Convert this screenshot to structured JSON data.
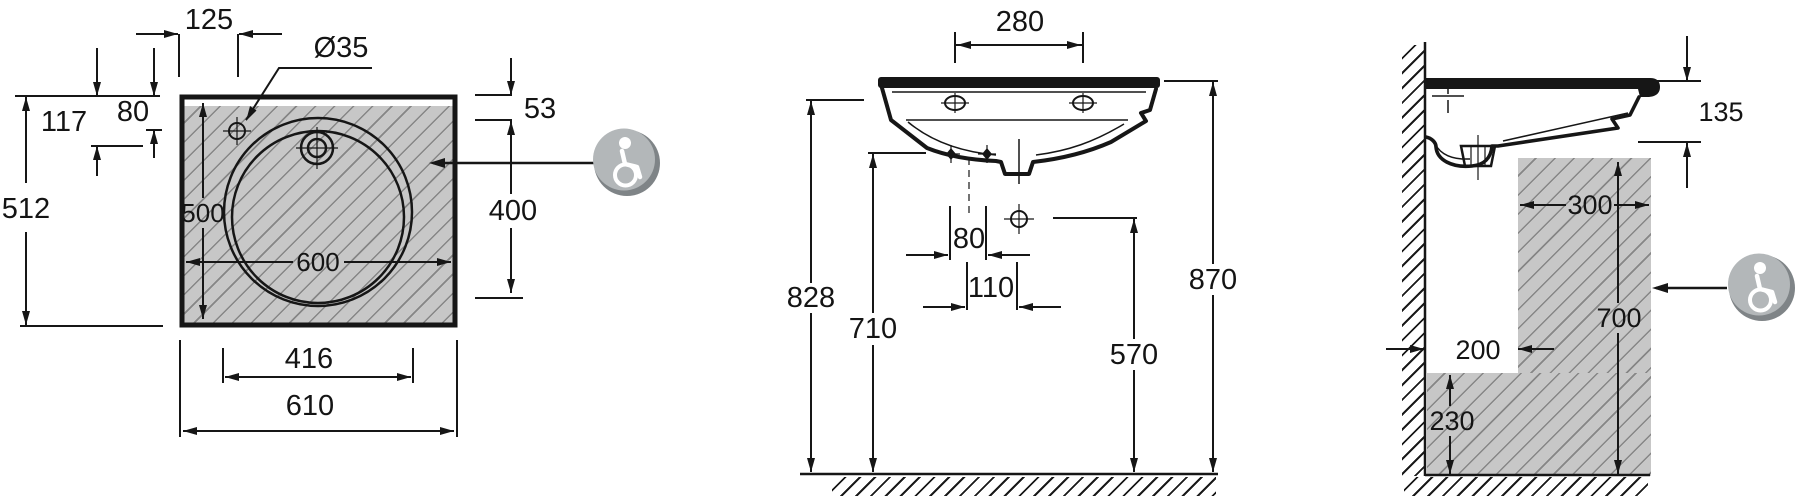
{
  "plan_view": {
    "dims": {
      "d125": "125",
      "d35": "Ø35",
      "d117": "117",
      "d80": "80",
      "d512": "512",
      "d500": "500",
      "d600": "600",
      "d416": "416",
      "d610": "610",
      "d53": "53",
      "d400": "400"
    }
  },
  "front_view": {
    "dims": {
      "d280": "280",
      "d828": "828",
      "d710": "710",
      "d80": "80",
      "d110": "110",
      "d570": "570",
      "d870": "870"
    }
  },
  "side_view": {
    "dims": {
      "d135": "135",
      "d300": "300",
      "d700": "700",
      "d200": "200",
      "d230": "230"
    }
  },
  "icons": {
    "left_accessibility": "wheelchair-accessibility",
    "right_accessibility": "wheelchair-accessibility"
  },
  "colors": {
    "line": "#161616",
    "zone_fill": "#c7c7c7",
    "zone_hatch": "#868686",
    "icon_sphere_dark": "#7f8487",
    "icon_sphere_light": "#b3b7b9",
    "icon_glyph": "#ffffff",
    "background": "#ffffff"
  }
}
